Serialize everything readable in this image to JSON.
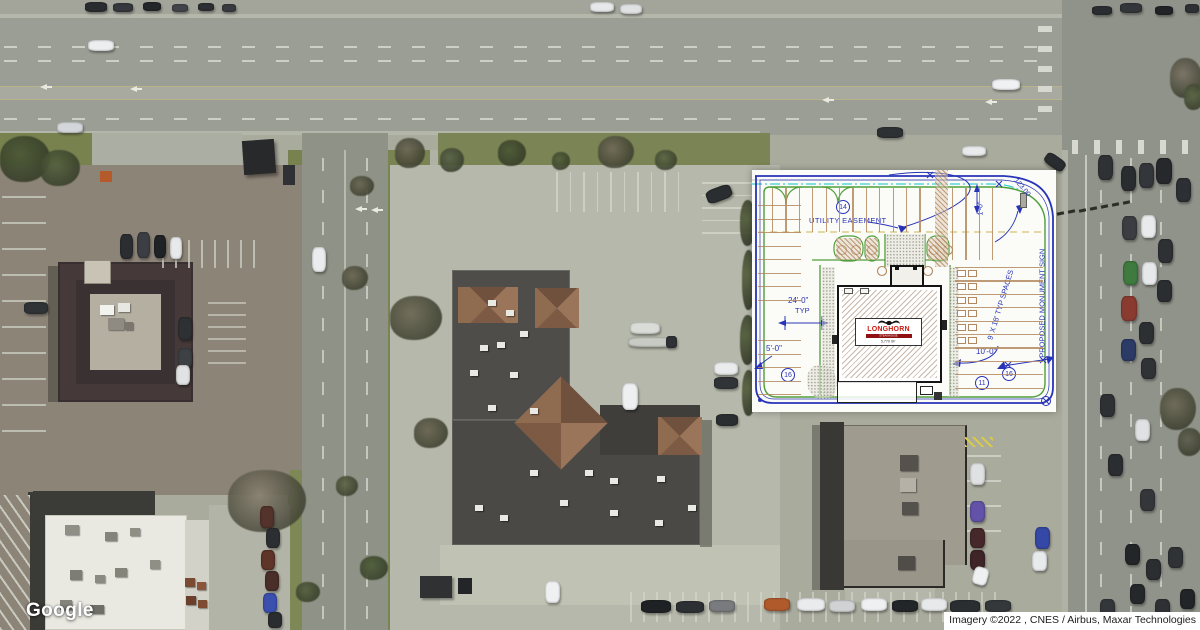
{
  "map": {
    "logo": "Google",
    "attribution": "Imagery ©2022 , CNES / Airbus, Maxar Technologies"
  },
  "site_plan": {
    "labels": {
      "utility_easement": "UTILITY EASEMENT",
      "dim_24": "24'-0\"",
      "typ": "TYP",
      "dim_5": "5'-0\"",
      "dim_10": "10'-0\"",
      "dim_1": "1'-0\"",
      "spaces": "9' X 18' TYP SPACES",
      "monument_sign": "PROPOSED MONUMENT SIGN",
      "curve_length": "123.00",
      "badge_14": "14",
      "badge_16_left": "16",
      "badge_11": "11",
      "badge_16_right": "16"
    },
    "logo": {
      "name": "LONGHORN",
      "sub": "STEAKHOUSE",
      "area_note": "5,770 SF"
    },
    "colors": {
      "line_blue": "#2834b8",
      "curb_green": "#4f9e3c",
      "easement_cyan": "#3ad0d6",
      "stripe_tan": "#b3885f",
      "dashed_yellow": "#d6c375",
      "logo_red": "#cc1a12"
    }
  }
}
